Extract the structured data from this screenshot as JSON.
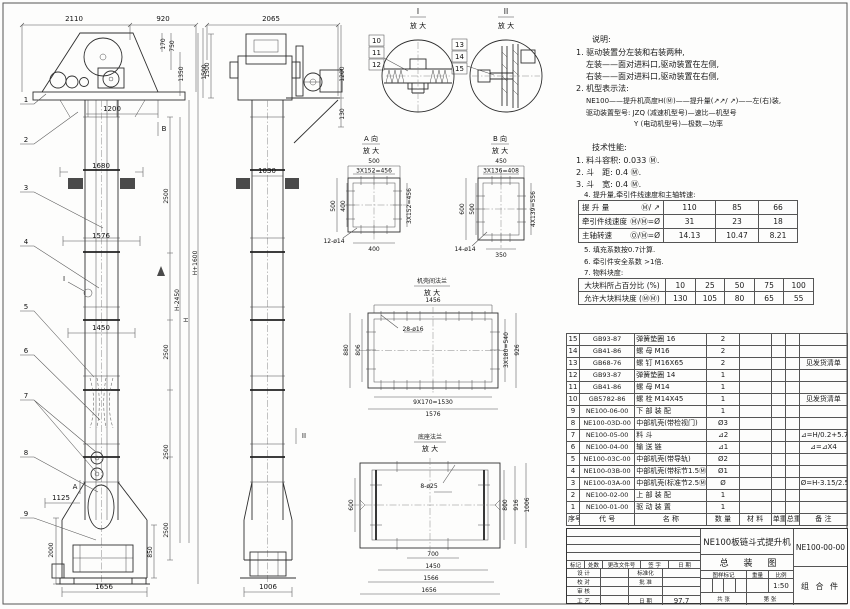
{
  "views": {
    "front": {
      "dims": {
        "w2110": "2110",
        "w920": "920",
        "h170": "170",
        "h750": "750",
        "h1350": "1350",
        "h1500": "1500",
        "w1200": "1200",
        "w1680": "1680",
        "w1576": "1576",
        "w1450": "1450",
        "seg2500": "2500",
        "hm2450": "H-2450",
        "h": "H",
        "hp1600": "H+1600",
        "w1125": "1125",
        "h2000": "2000",
        "h850": "850",
        "w1656": "1656"
      },
      "markers": {
        "a": "A",
        "b": "B",
        "i": "I"
      },
      "leaders": [
        "1",
        "2",
        "3",
        "4",
        "5",
        "6",
        "7",
        "8",
        "9"
      ]
    },
    "side": {
      "dims": {
        "w2065": "2065",
        "h1500": "1500",
        "h1200": "1200",
        "h130": "130",
        "w1030": "1030",
        "w1006": "1006"
      },
      "marker_ii": "II",
      "leaders_i": [
        "10",
        "11",
        "12"
      ],
      "leaders_ii": [
        "13",
        "14",
        "15"
      ]
    },
    "detail_i": {
      "title": "I",
      "sub": "放 大"
    },
    "detail_ii": {
      "title": "II",
      "sub": "放 大"
    },
    "detail_a": {
      "title": "A 向",
      "sub": "放 大",
      "top": "500",
      "top2": "3X152=456",
      "left": "500",
      "left2": "400",
      "right": "3X152=456",
      "bottom": "400",
      "holes": "12-ø14"
    },
    "detail_b": {
      "title": "B 向",
      "sub": "放 大",
      "top": "450",
      "top2": "3X136=408",
      "left": "600",
      "left2": "500",
      "right": "4X139=556",
      "bottom": "350",
      "holes": "14-ø14"
    },
    "detail_flange": {
      "title": "机壳间法兰",
      "sub": "放 大",
      "top": "1456",
      "left": "880",
      "left2": "806",
      "right": "3X180=540",
      "right2": "926",
      "bottom": "9X170=1530",
      "bottom2": "1576",
      "holes": "28-ø16"
    },
    "detail_base": {
      "title": "底座法兰",
      "sub": "放 大",
      "left": "600",
      "right": "800",
      "right2": "916",
      "right3": "1006",
      "bottom": "700",
      "bottom2": "1450",
      "bottom3": "1566",
      "bottom4": "1656",
      "holes": "8-ø25"
    }
  },
  "notes": {
    "heading": "说明:",
    "l1": "1. 驱动装置分左装和右装两种,",
    "l2": "左装——面对进料口,驱动装置在左侧,",
    "l3": "右装——面对进料口,驱动装置在右侧,",
    "l4": "2. 机型表示法:",
    "l5": "NE100——提升机高度H(Ⓜ)——提升量(↗↗/ ↗)——左(右)装,",
    "l6": "驱动装置型号: JZQ (减速机型号)—速比—机型号",
    "l7": "Y (电动机型号)—极数—功率"
  },
  "tech": {
    "heading": "技术性能:",
    "l1": "1. 料斗容积: 0.033 Ⓜ.",
    "l2": "2. 斗　距: 0.4 Ⓜ.",
    "l3": "3. 斗　宽: 0.4 Ⓜ.",
    "l4": "4. 提升量,牵引件线速度和主轴转速:",
    "l5": "5. 填充系数按0.7计算.",
    "l6": "6. 牵引件安全系数 >1倍.",
    "l7": "7. 物料块度:"
  },
  "speed_table": {
    "rows": [
      {
        "label": "提 升 量",
        "unit": "Ⓜ/ ↗",
        "v": [
          "110",
          "85",
          "66"
        ]
      },
      {
        "label": "牵引件线速度",
        "unit": "Ⓜ/Ⓜ=Ø",
        "v": [
          "31",
          "23",
          "18"
        ]
      },
      {
        "label": "主轴转速",
        "unit": "Ⓞ/Ⓜ=Ø",
        "v": [
          "14.13",
          "10.47",
          "8.21"
        ]
      }
    ]
  },
  "lump_table": {
    "rows": [
      {
        "label": "大块料所占百分比 (%)",
        "v": [
          "10",
          "25",
          "50",
          "75",
          "100"
        ]
      },
      {
        "label": "允许大块料块度 (ⓂⓂ)",
        "v": [
          "130",
          "105",
          "80",
          "65",
          "55"
        ]
      }
    ]
  },
  "bom": {
    "headers": [
      "序号",
      "代 号",
      "名 称",
      "数 量",
      "材 料",
      "单重",
      "总重",
      "备 注"
    ],
    "rows": [
      {
        "no": "15",
        "code": "GB93-87",
        "name": "弹簧垫圈 16",
        "qty": "2",
        "mat": "",
        "uw": "",
        "tw": "",
        "note": ""
      },
      {
        "no": "14",
        "code": "GB41-86",
        "name": "螺 母 M16",
        "qty": "2",
        "mat": "",
        "uw": "",
        "tw": "",
        "note": ""
      },
      {
        "no": "13",
        "code": "GB68-76",
        "name": "螺 钉 M16X65",
        "qty": "2",
        "mat": "",
        "uw": "",
        "tw": "",
        "note": "见发货清单"
      },
      {
        "no": "12",
        "code": "GB93-87",
        "name": "弹簧垫圈 14",
        "qty": "1",
        "mat": "",
        "uw": "",
        "tw": "",
        "note": ""
      },
      {
        "no": "11",
        "code": "GB41-86",
        "name": "螺 母 M14",
        "qty": "1",
        "mat": "",
        "uw": "",
        "tw": "",
        "note": ""
      },
      {
        "no": "10",
        "code": "GB5782-86",
        "name": "螺 栓 M14X45",
        "qty": "1",
        "mat": "",
        "uw": "",
        "tw": "",
        "note": "见发货清单"
      },
      {
        "no": "9",
        "code": "NE100-06-00",
        "name": "下 部 装 配",
        "qty": "1",
        "mat": "",
        "uw": "",
        "tw": "",
        "note": ""
      },
      {
        "no": "8",
        "code": "NE100-03D-00",
        "name": "中部机壳(带检视门)",
        "qty": "Ø3",
        "mat": "",
        "uw": "",
        "tw": "",
        "note": ""
      },
      {
        "no": "7",
        "code": "NE100-05-00",
        "name": "料 斗",
        "qty": "⊿2",
        "mat": "",
        "uw": "",
        "tw": "",
        "note": "⊿=H/0.2+5.75"
      },
      {
        "no": "6",
        "code": "NE100-04-00",
        "name": "输 送 链",
        "qty": "⊿1",
        "mat": "",
        "uw": "",
        "tw": "",
        "note": "⊿=⊿X4"
      },
      {
        "no": "5",
        "code": "NE100-03C-00",
        "name": "中部机壳(带导轨)",
        "qty": "Ø2",
        "mat": "",
        "uw": "",
        "tw": "",
        "note": ""
      },
      {
        "no": "4",
        "code": "NE100-03B-00",
        "name": "中部机壳(带标节1.5Ⓜ,1Ⓜ)",
        "qty": "Ø1",
        "mat": "",
        "uw": "",
        "tw": "",
        "note": ""
      },
      {
        "no": "3",
        "code": "NE100-03A-00",
        "name": "中部机壳(标准节2.5Ⓜ)",
        "qty": "Ø",
        "mat": "",
        "uw": "",
        "tw": "",
        "note": "Ø=H-3.15/2.5"
      },
      {
        "no": "2",
        "code": "NE100-02-00",
        "name": "上 部 装 配",
        "qty": "1",
        "mat": "",
        "uw": "",
        "tw": "",
        "note": ""
      },
      {
        "no": "1",
        "code": "NE100-01-00",
        "name": "驱 动 装 置",
        "qty": "1",
        "mat": "",
        "uw": "",
        "tw": "",
        "note": ""
      }
    ]
  },
  "titleblock": {
    "rev_headers": [
      "标记",
      "处数",
      "更改文件号",
      "签 字",
      "日 期"
    ],
    "sign_rows": [
      [
        "设 计",
        "标准化",
        ""
      ],
      [
        "校 对",
        "批 准",
        ""
      ],
      [
        "审 核",
        "",
        ""
      ],
      [
        "工 艺",
        "日 期",
        "97.7"
      ]
    ],
    "title_line1": "NE100板链斗式提升机",
    "title_line2": "总 装 图",
    "stamp_headers": [
      "图样标记",
      "重量",
      "比例"
    ],
    "scale": "1:50",
    "sheet_total": "共  张",
    "sheet_no": "第  张",
    "dwg_no": "NE100-00-00",
    "part_type": "组 合 件"
  }
}
